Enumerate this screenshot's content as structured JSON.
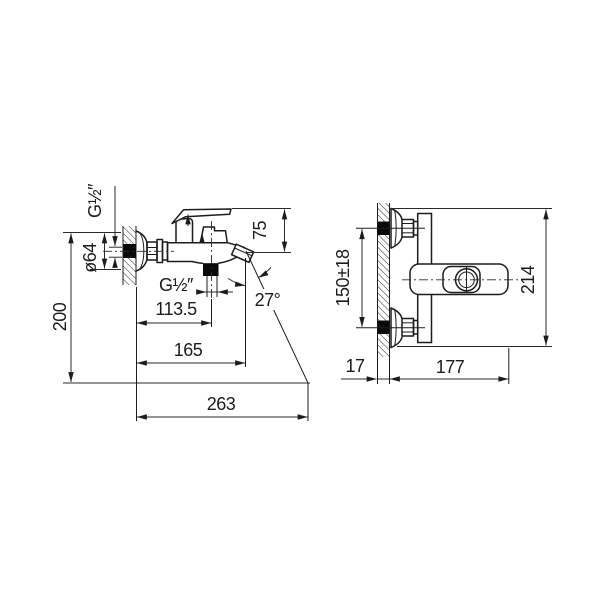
{
  "drawing": {
    "type": "faucet-installation-dimensions",
    "units": "mm",
    "side_view": {
      "inlet_thread_label": "G½″",
      "flange_diameter_label": "ø64",
      "mounting_height_label": "200",
      "spout_outlet_thread_label": "G½″",
      "spout_reach_label": "113.5",
      "spout_reach_total_label": "165",
      "overall_depth_label": "263",
      "handle_height_label": "75",
      "spout_angle_label": "27°"
    },
    "front_view": {
      "inlet_spacing_label": "150±18",
      "overall_height_label": "214",
      "wall_thickness_label": "17",
      "body_width_label": "177"
    }
  }
}
